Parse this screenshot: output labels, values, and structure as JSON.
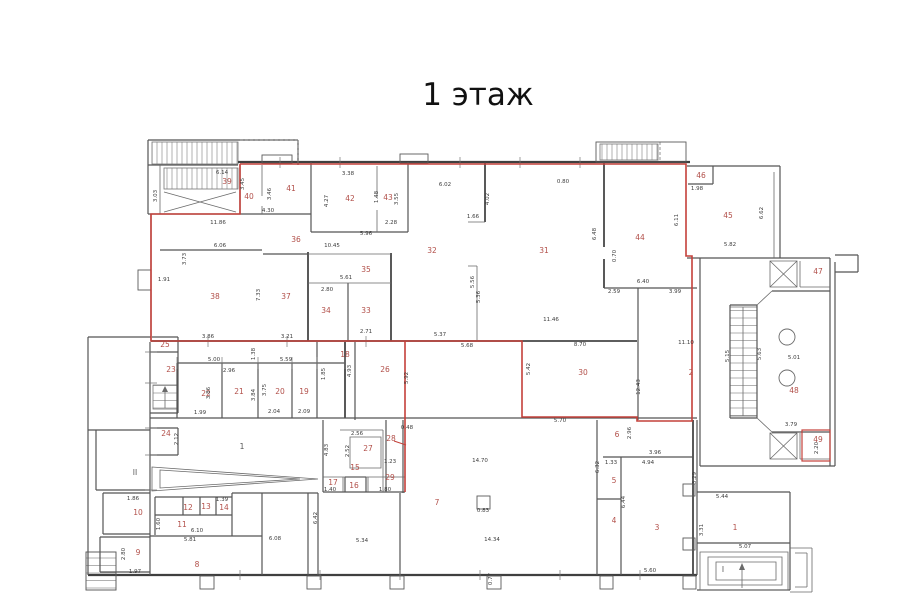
{
  "title": "1 этаж",
  "colors": {
    "boundary_red": "#c4403a",
    "room_label_red": "#b2504a",
    "wall_dark": "#3f3f3f",
    "wall_medium": "#5a5a5a",
    "dim_text": "#3c3c3c"
  },
  "plan": {
    "room_labels": [
      {
        "t": "39",
        "x": 227,
        "y": 184
      },
      {
        "t": "40",
        "x": 249,
        "y": 199
      },
      {
        "t": "41",
        "x": 291,
        "y": 191
      },
      {
        "t": "42",
        "x": 350,
        "y": 201
      },
      {
        "t": "43",
        "x": 388,
        "y": 200
      },
      {
        "t": "44",
        "x": 640,
        "y": 240
      },
      {
        "t": "45",
        "x": 728,
        "y": 218
      },
      {
        "t": "46",
        "x": 701,
        "y": 178
      },
      {
        "t": "47",
        "x": 818,
        "y": 274
      },
      {
        "t": "48",
        "x": 794,
        "y": 393
      },
      {
        "t": "49",
        "x": 818,
        "y": 442
      },
      {
        "t": "38",
        "x": 215,
        "y": 299
      },
      {
        "t": "37",
        "x": 286,
        "y": 299
      },
      {
        "t": "36",
        "x": 296,
        "y": 242
      },
      {
        "t": "35",
        "x": 366,
        "y": 272
      },
      {
        "t": "34",
        "x": 326,
        "y": 313
      },
      {
        "t": "33",
        "x": 366,
        "y": 313
      },
      {
        "t": "32",
        "x": 432,
        "y": 253
      },
      {
        "t": "31",
        "x": 544,
        "y": 253
      },
      {
        "t": "30",
        "x": 583,
        "y": 375
      },
      {
        "t": "29",
        "x": 390,
        "y": 480
      },
      {
        "t": "28",
        "x": 391,
        "y": 441
      },
      {
        "t": "27",
        "x": 368,
        "y": 451
      },
      {
        "t": "26",
        "x": 385,
        "y": 372
      },
      {
        "t": "25",
        "x": 165,
        "y": 347
      },
      {
        "t": "24",
        "x": 166,
        "y": 436
      },
      {
        "t": "23",
        "x": 171,
        "y": 372
      },
      {
        "t": "22",
        "x": 206,
        "y": 396
      },
      {
        "t": "21",
        "x": 239,
        "y": 394
      },
      {
        "t": "20",
        "x": 280,
        "y": 394
      },
      {
        "t": "19",
        "x": 304,
        "y": 394
      },
      {
        "t": "18",
        "x": 345,
        "y": 357
      },
      {
        "t": "17",
        "x": 333,
        "y": 485
      },
      {
        "t": "16",
        "x": 354,
        "y": 488
      },
      {
        "t": "15",
        "x": 355,
        "y": 470
      },
      {
        "t": "14",
        "x": 224,
        "y": 510
      },
      {
        "t": "13",
        "x": 206,
        "y": 509
      },
      {
        "t": "12",
        "x": 188,
        "y": 510
      },
      {
        "t": "11",
        "x": 182,
        "y": 527
      },
      {
        "t": "10",
        "x": 138,
        "y": 515
      },
      {
        "t": "9",
        "x": 138,
        "y": 555
      },
      {
        "t": "8",
        "x": 197,
        "y": 567
      },
      {
        "t": "7",
        "x": 437,
        "y": 505
      },
      {
        "t": "6",
        "x": 617,
        "y": 437
      },
      {
        "t": "5",
        "x": 614,
        "y": 483
      },
      {
        "t": "4",
        "x": 614,
        "y": 523
      },
      {
        "t": "3",
        "x": 657,
        "y": 530
      },
      {
        "t": "2",
        "x": 691,
        "y": 375
      },
      {
        "t": "1",
        "x": 735,
        "y": 530
      }
    ],
    "space_labels": [
      {
        "t": "1",
        "x": 242,
        "y": 449
      },
      {
        "t": "II",
        "x": 135,
        "y": 475
      },
      {
        "t": "I",
        "x": 723,
        "y": 572
      }
    ],
    "dim_labels": [
      {
        "t": "6.14",
        "x": 222,
        "y": 174
      },
      {
        "t": "4.30",
        "x": 268,
        "y": 212
      },
      {
        "t": "11.86",
        "x": 218,
        "y": 224
      },
      {
        "t": "3.38",
        "x": 348,
        "y": 175
      },
      {
        "t": "2.28",
        "x": 391,
        "y": 224
      },
      {
        "t": "5.96",
        "x": 366,
        "y": 235
      },
      {
        "t": "6.02",
        "x": 445,
        "y": 186
      },
      {
        "t": "1.66",
        "x": 473,
        "y": 218
      },
      {
        "t": "0.80",
        "x": 563,
        "y": 183
      },
      {
        "t": "1.98",
        "x": 697,
        "y": 190
      },
      {
        "t": "5.82",
        "x": 730,
        "y": 246
      },
      {
        "t": "6.40",
        "x": 643,
        "y": 283
      },
      {
        "t": "2.59",
        "x": 614,
        "y": 293
      },
      {
        "t": "3.99",
        "x": 675,
        "y": 293
      },
      {
        "t": "6.06",
        "x": 220,
        "y": 247
      },
      {
        "t": "10.45",
        "x": 332,
        "y": 247
      },
      {
        "t": "1.91",
        "x": 164,
        "y": 281
      },
      {
        "t": "5.61",
        "x": 346,
        "y": 279
      },
      {
        "t": "2.80",
        "x": 327,
        "y": 291
      },
      {
        "t": "2.71",
        "x": 366,
        "y": 333
      },
      {
        "t": "3.86",
        "x": 208,
        "y": 338
      },
      {
        "t": "3.21",
        "x": 287,
        "y": 338
      },
      {
        "t": "11.46",
        "x": 551,
        "y": 321
      },
      {
        "t": "5.37",
        "x": 440,
        "y": 336
      },
      {
        "t": "5.68",
        "x": 467,
        "y": 347
      },
      {
        "t": "8.70",
        "x": 580,
        "y": 346
      },
      {
        "t": "11.10",
        "x": 686,
        "y": 344
      },
      {
        "t": "5.70",
        "x": 560,
        "y": 422
      },
      {
        "t": "5.00",
        "x": 214,
        "y": 361
      },
      {
        "t": "2.96",
        "x": 229,
        "y": 372
      },
      {
        "t": "5.59",
        "x": 286,
        "y": 361
      },
      {
        "t": "1.99",
        "x": 200,
        "y": 414
      },
      {
        "t": "2.04",
        "x": 274,
        "y": 413
      },
      {
        "t": "2.09",
        "x": 304,
        "y": 413
      },
      {
        "t": "0.48",
        "x": 407,
        "y": 429
      },
      {
        "t": "2.56",
        "x": 357,
        "y": 435
      },
      {
        "t": "1.23",
        "x": 390,
        "y": 463
      },
      {
        "t": "1.40",
        "x": 330,
        "y": 491
      },
      {
        "t": "1.80",
        "x": 385,
        "y": 491
      },
      {
        "t": "1.86",
        "x": 133,
        "y": 500
      },
      {
        "t": "1.39",
        "x": 222,
        "y": 501
      },
      {
        "t": "6.10",
        "x": 197,
        "y": 532
      },
      {
        "t": "5.81",
        "x": 190,
        "y": 541
      },
      {
        "t": "1.97",
        "x": 135,
        "y": 573
      },
      {
        "t": "6.08",
        "x": 275,
        "y": 540
      },
      {
        "t": "5.34",
        "x": 362,
        "y": 542
      },
      {
        "t": "14.34",
        "x": 492,
        "y": 541
      },
      {
        "t": "14.70",
        "x": 480,
        "y": 462
      },
      {
        "t": "0.83",
        "x": 483,
        "y": 512
      },
      {
        "t": "3.96",
        "x": 655,
        "y": 454
      },
      {
        "t": "4.94",
        "x": 648,
        "y": 464
      },
      {
        "t": "1.33",
        "x": 611,
        "y": 464
      },
      {
        "t": "5.44",
        "x": 722,
        "y": 498
      },
      {
        "t": "5.07",
        "x": 745,
        "y": 548
      },
      {
        "t": "5.60",
        "x": 650,
        "y": 572
      },
      {
        "t": "5.01",
        "x": 794,
        "y": 359
      },
      {
        "t": "3.79",
        "x": 791,
        "y": 426
      },
      {
        "t": "3.03",
        "x": 157,
        "y": 196,
        "r": 1
      },
      {
        "t": "3.45",
        "x": 244,
        "y": 184,
        "r": 1
      },
      {
        "t": "3.46",
        "x": 271,
        "y": 194,
        "r": 1
      },
      {
        "t": "4.27",
        "x": 328,
        "y": 201,
        "r": 1
      },
      {
        "t": "1.48",
        "x": 378,
        "y": 197,
        "r": 1
      },
      {
        "t": "3.55",
        "x": 398,
        "y": 199,
        "r": 1
      },
      {
        "t": "4.02",
        "x": 489,
        "y": 199,
        "r": 1
      },
      {
        "t": "6.48",
        "x": 596,
        "y": 234,
        "r": 1
      },
      {
        "t": "6.11",
        "x": 678,
        "y": 220,
        "r": 1
      },
      {
        "t": "6.62",
        "x": 763,
        "y": 213,
        "r": 1
      },
      {
        "t": "0.70",
        "x": 616,
        "y": 256,
        "r": 1
      },
      {
        "t": "3.73",
        "x": 186,
        "y": 259,
        "r": 1
      },
      {
        "t": "7.33",
        "x": 260,
        "y": 295,
        "r": 1
      },
      {
        "t": "5.56",
        "x": 474,
        "y": 282,
        "r": 1
      },
      {
        "t": "5.36",
        "x": 480,
        "y": 297,
        "r": 1
      },
      {
        "t": "5.42",
        "x": 530,
        "y": 369,
        "r": 1
      },
      {
        "t": "12.43",
        "x": 640,
        "y": 387,
        "r": 1
      },
      {
        "t": "1.38",
        "x": 255,
        "y": 354,
        "r": 1
      },
      {
        "t": "3.84",
        "x": 255,
        "y": 395,
        "r": 1
      },
      {
        "t": "3.75",
        "x": 266,
        "y": 390,
        "r": 1
      },
      {
        "t": "1.85",
        "x": 325,
        "y": 374,
        "r": 1
      },
      {
        "t": "4.93",
        "x": 351,
        "y": 371,
        "r": 1
      },
      {
        "t": "3.86",
        "x": 210,
        "y": 393,
        "r": 1
      },
      {
        "t": "2.12",
        "x": 178,
        "y": 439,
        "r": 1
      },
      {
        "t": "5.92",
        "x": 408,
        "y": 378,
        "r": 1
      },
      {
        "t": "2.52",
        "x": 349,
        "y": 451,
        "r": 1
      },
      {
        "t": "4.83",
        "x": 328,
        "y": 450,
        "r": 1
      },
      {
        "t": "1.60",
        "x": 160,
        "y": 524,
        "r": 1
      },
      {
        "t": "2.80",
        "x": 125,
        "y": 554,
        "r": 1
      },
      {
        "t": "6.42",
        "x": 317,
        "y": 518,
        "r": 1
      },
      {
        "t": "6.32",
        "x": 599,
        "y": 467,
        "r": 1
      },
      {
        "t": "2.96",
        "x": 631,
        "y": 433,
        "r": 1
      },
      {
        "t": "3.29",
        "x": 696,
        "y": 478,
        "r": 1
      },
      {
        "t": "6.44",
        "x": 625,
        "y": 502,
        "r": 1
      },
      {
        "t": "3.31",
        "x": 703,
        "y": 530,
        "r": 1
      },
      {
        "t": "5.15",
        "x": 729,
        "y": 356,
        "r": 1
      },
      {
        "t": "5.63",
        "x": 761,
        "y": 354,
        "r": 1
      },
      {
        "t": "2.20",
        "x": 818,
        "y": 448,
        "r": 1
      },
      {
        "t": "0.77",
        "x": 492,
        "y": 579,
        "r": 1
      }
    ]
  }
}
